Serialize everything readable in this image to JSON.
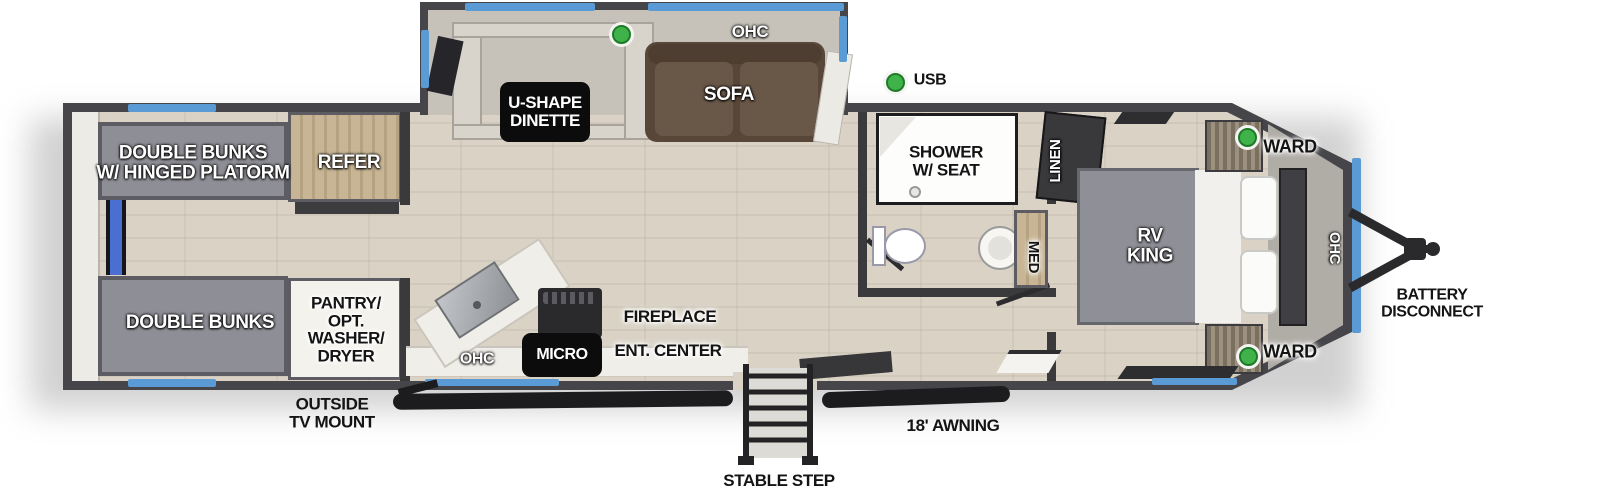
{
  "title": "RV travel trailer floorplan",
  "labels": {
    "bunks_top": "DOUBLE BUNKS\nW/ HINGED PLATORM",
    "bunks_bottom": "DOUBLE BUNKS",
    "refer": "REFER",
    "pantry": "PANTRY/\nOPT.\nWASHER/\nDRYER",
    "dinette": "U-SHAPE\nDINETTE",
    "sofa": "SOFA",
    "ohc_slide": "OHC",
    "usb": "USB",
    "shower": "SHOWER\nW/ SEAT",
    "linen": "LINEN",
    "med": "MED",
    "rv_king": "RV\nKING",
    "ward_top": "WARD",
    "ward_bottom": "WARD",
    "ohc_bedroom": "OHC",
    "battery_disconnect": "BATTERY\nDISCONNECT",
    "fireplace": "FIREPLACE",
    "ent_center": "ENT. CENTER",
    "micro": "MICRO",
    "ohc_kitchen": "OHC",
    "outside_tv_mount": "OUTSIDE\nTV MOUNT",
    "awning": "18' AWNING",
    "stable_step": "STABLE STEP"
  },
  "colors": {
    "wall": "#46464a",
    "wall_dark": "#3a3a3d",
    "floor": "#d9d2c5",
    "slide_floor": "#c6c2ba",
    "bunk": "#8e8e96",
    "sofa": "#584739",
    "sofa_cushion": "#695748",
    "wood": "#c7b595",
    "blue": "#5b9bd5",
    "ladder_blue": "#4a6fd0",
    "green": "#3fb24a",
    "counter": "#f0eee8",
    "nose_cab": "#b0aca6",
    "bed": "#8f8f97",
    "awning_bar": "#1c1c1e"
  }
}
